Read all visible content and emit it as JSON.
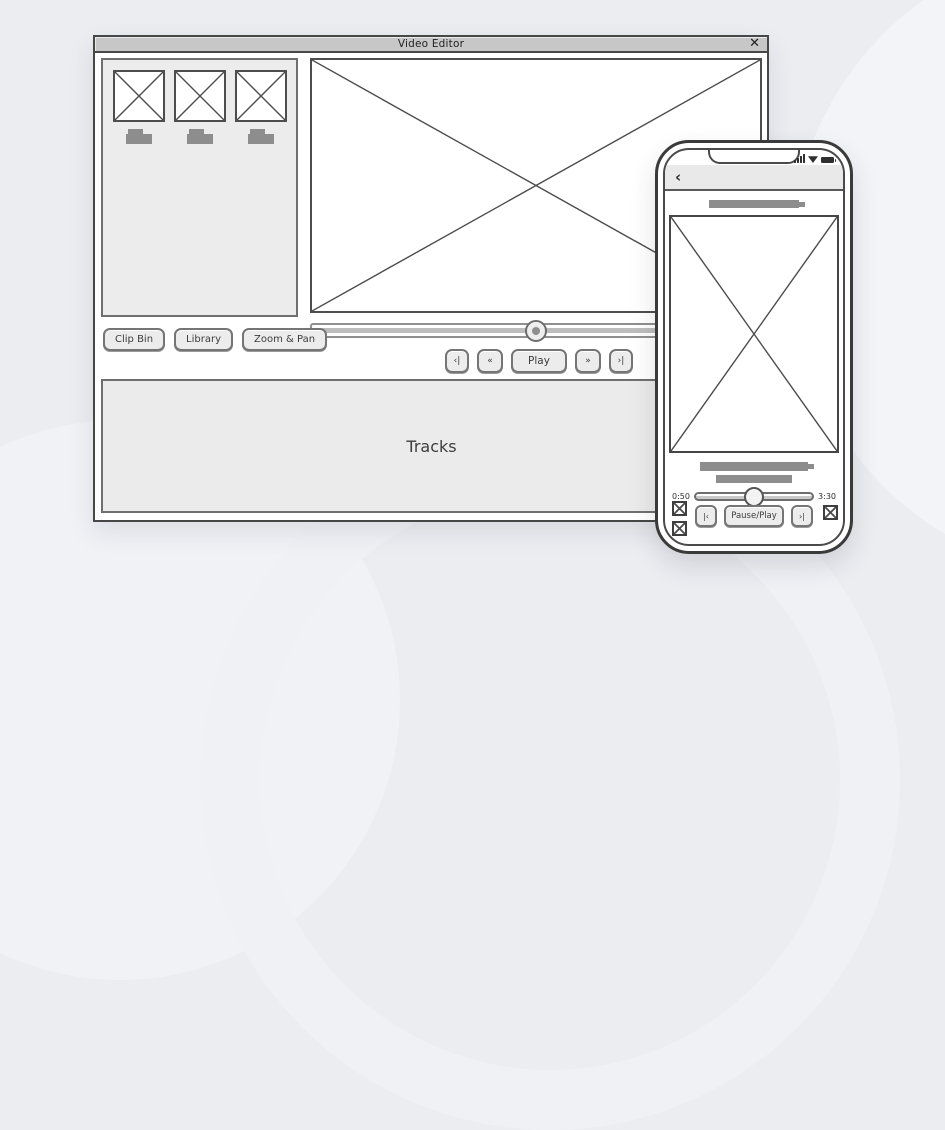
{
  "background": {
    "color": "#ecedf1"
  },
  "window": {
    "title": "Video Editor",
    "close_label": "✕",
    "clip_bin": {
      "thumbnail_count": 3
    },
    "panel_buttons": [
      {
        "label": "Clip Bin"
      },
      {
        "label": "Library"
      },
      {
        "label": "Zoom & Pan"
      }
    ],
    "scrubber": {
      "position_pct": 50
    },
    "transport": [
      {
        "label": "‹|"
      },
      {
        "label": "«"
      },
      {
        "label": "Play"
      },
      {
        "label": "»"
      },
      {
        "label": "›|"
      }
    ],
    "tracks": {
      "label": "Tracks"
    }
  },
  "phone": {
    "back_label": "‹",
    "status_icons": [
      "cellular-signal",
      "wifi",
      "battery"
    ],
    "player": {
      "elapsed": "0:50",
      "duration": "3:30",
      "position_pct": 50
    },
    "controls": [
      {
        "label": "|‹"
      },
      {
        "label": "Pause/Play"
      },
      {
        "label": "›|"
      }
    ]
  },
  "colors": {
    "window_titlebar": "#c7c7c7",
    "panel_fill": "#ececec",
    "placeholder_gray": "#8d8d8d",
    "line_dark": "#4a4a4a"
  }
}
